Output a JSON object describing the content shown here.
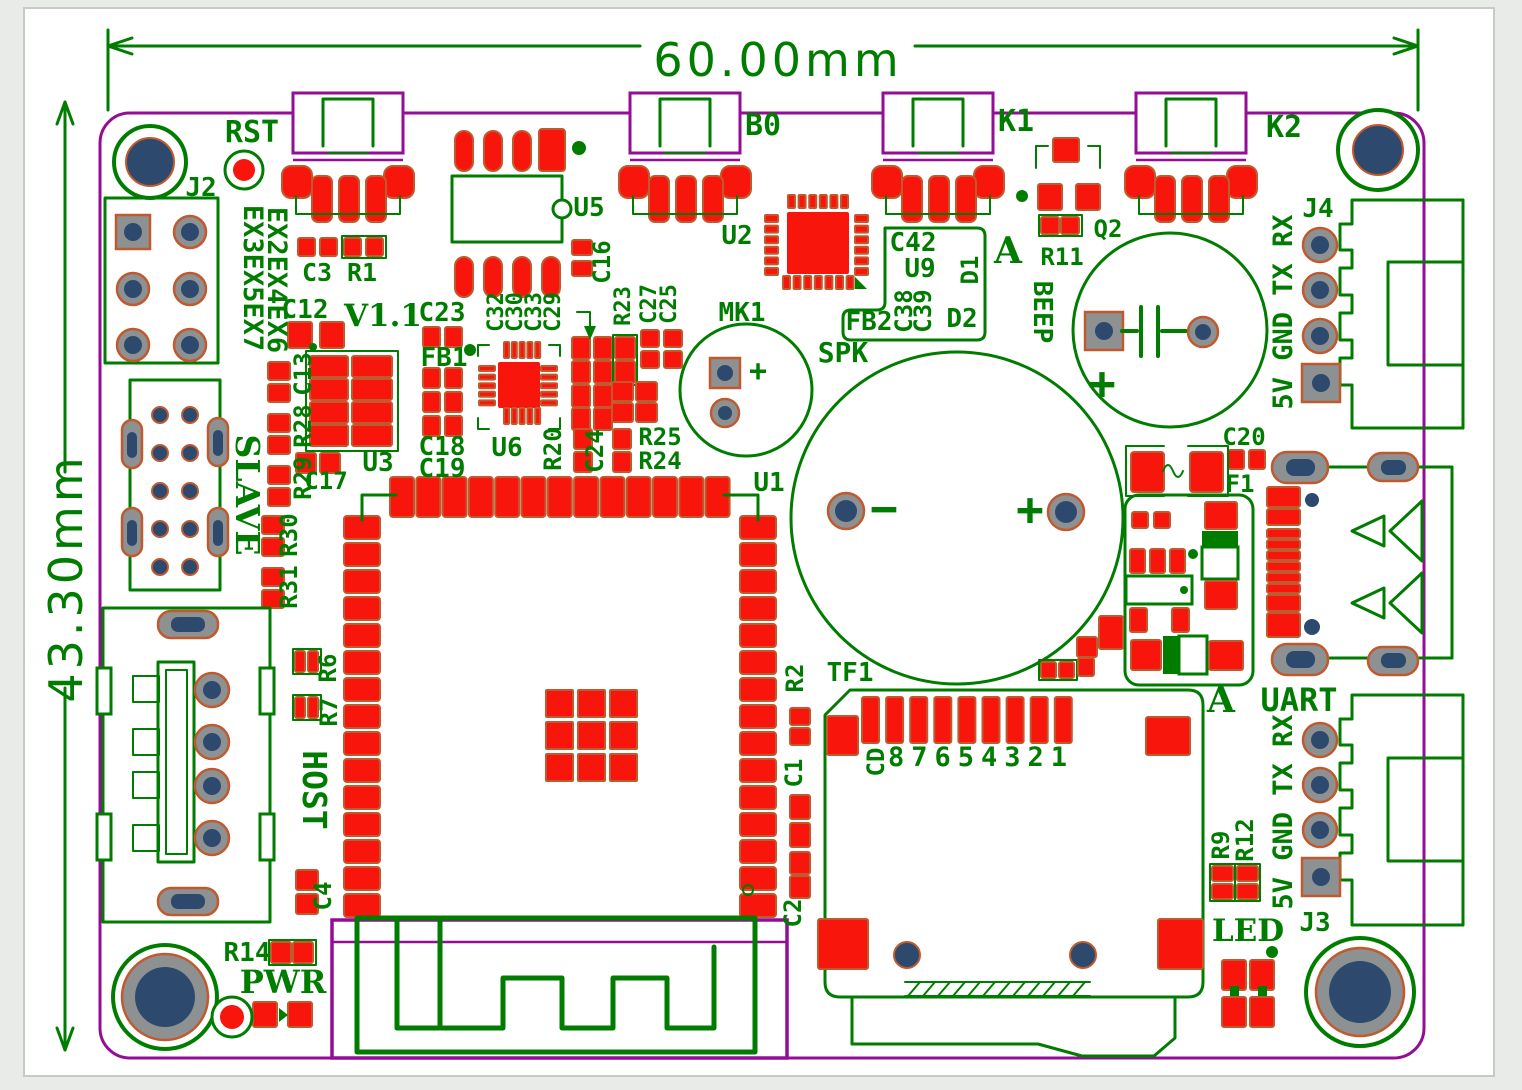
{
  "meta": {
    "type": "pcb-layout-drawing",
    "board_version": "V1.1"
  },
  "dimensions": {
    "width": "60.00mm",
    "height": "43.30mm"
  },
  "colors": {
    "silkscreen": "#007d00",
    "copper_pad": "#f8150b",
    "pad_outline": "#c05a2e",
    "board_edge": "#930d96",
    "drill_hole": "#2d4a6e",
    "pad_ring_gray": "#8e9192",
    "background": "#e9ebe8",
    "canvas": "#ffffff"
  },
  "labels": [
    {
      "t": "60.00mm",
      "x": 778,
      "y": 76,
      "s": 46,
      "c": "dim",
      "ls": 4
    },
    {
      "t": "43.30mm",
      "x": 82,
      "y": 578,
      "r": -90,
      "s": 46,
      "c": "dim",
      "ls": 4
    },
    {
      "t": "RST",
      "x": 252,
      "y": 142,
      "s": 30
    },
    {
      "t": "J2",
      "x": 201,
      "y": 196,
      "s": 26
    },
    {
      "t": "EX3EX5EX7",
      "x": 244,
      "y": 278,
      "r": 90,
      "s": 27
    },
    {
      "t": "EX2EX4EX6",
      "x": 268,
      "y": 280,
      "r": 90,
      "s": 27
    },
    {
      "t": "C3",
      "x": 317,
      "y": 281,
      "s": 25
    },
    {
      "t": "R1",
      "x": 362,
      "y": 281,
      "s": 25
    },
    {
      "t": "C12",
      "x": 305,
      "y": 318,
      "s": 26
    },
    {
      "t": "V1.1",
      "x": 383,
      "y": 326,
      "s": 31,
      "c": "b"
    },
    {
      "t": "C23",
      "x": 442,
      "y": 321,
      "s": 26
    },
    {
      "t": "FB1",
      "x": 444,
      "y": 366,
      "s": 26
    },
    {
      "t": "C18",
      "x": 442,
      "y": 455,
      "s": 26
    },
    {
      "t": "C19",
      "x": 442,
      "y": 477,
      "s": 26
    },
    {
      "t": "U3",
      "x": 378,
      "y": 471,
      "s": 26
    },
    {
      "t": "C13",
      "x": 311,
      "y": 374,
      "r": -90,
      "s": 24
    },
    {
      "t": "R28",
      "x": 311,
      "y": 426,
      "r": -90,
      "s": 24
    },
    {
      "t": "R29",
      "x": 311,
      "y": 478,
      "r": -90,
      "s": 24
    },
    {
      "t": "C17",
      "x": 326,
      "y": 489,
      "s": 24
    },
    {
      "t": "R30",
      "x": 297,
      "y": 535,
      "r": -90,
      "s": 24
    },
    {
      "t": "R31",
      "x": 297,
      "y": 587,
      "r": -90,
      "s": 24
    },
    {
      "t": "SLAVE",
      "x": 236,
      "y": 495,
      "r": 90,
      "s": 33,
      "c": "b"
    },
    {
      "t": "HOST",
      "x": 303,
      "y": 790,
      "r": 90,
      "s": 33
    },
    {
      "t": "R6",
      "x": 336,
      "y": 668,
      "r": -90,
      "s": 24
    },
    {
      "t": "R7",
      "x": 337,
      "y": 712,
      "r": -90,
      "s": 24
    },
    {
      "t": "C4",
      "x": 331,
      "y": 896,
      "r": -90,
      "s": 24
    },
    {
      "t": "R14",
      "x": 247,
      "y": 961,
      "s": 26
    },
    {
      "t": "PWR",
      "x": 283,
      "y": 993,
      "s": 32,
      "c": "b"
    },
    {
      "t": "U5",
      "x": 589,
      "y": 216,
      "s": 26
    },
    {
      "t": "C16",
      "x": 610,
      "y": 262,
      "r": -90,
      "s": 24
    },
    {
      "t": "C32",
      "x": 503,
      "y": 312,
      "r": -90,
      "s": 22
    },
    {
      "t": "C30",
      "x": 522,
      "y": 312,
      "r": -90,
      "s": 22
    },
    {
      "t": "C33",
      "x": 541,
      "y": 312,
      "r": -90,
      "s": 22
    },
    {
      "t": "C29",
      "x": 560,
      "y": 312,
      "r": -90,
      "s": 22
    },
    {
      "t": "R23",
      "x": 630,
      "y": 306,
      "r": -90,
      "s": 22
    },
    {
      "t": "C27",
      "x": 656,
      "y": 304,
      "r": -90,
      "s": 22
    },
    {
      "t": "C25",
      "x": 676,
      "y": 304,
      "r": -90,
      "s": 22
    },
    {
      "t": "U6",
      "x": 507,
      "y": 456,
      "s": 26
    },
    {
      "t": "R20",
      "x": 561,
      "y": 449,
      "r": -90,
      "s": 24
    },
    {
      "t": "C24",
      "x": 603,
      "y": 451,
      "r": -90,
      "s": 24
    },
    {
      "t": "R25",
      "x": 660,
      "y": 445,
      "s": 24
    },
    {
      "t": "R24",
      "x": 660,
      "y": 469,
      "s": 24
    },
    {
      "t": "U1",
      "x": 769,
      "y": 491,
      "s": 26
    },
    {
      "t": "B0",
      "x": 763,
      "y": 135,
      "s": 30
    },
    {
      "t": "U2",
      "x": 737,
      "y": 244,
      "s": 26
    },
    {
      "t": "MK1",
      "x": 742,
      "y": 321,
      "s": 26
    },
    {
      "t": "SPK",
      "x": 843,
      "y": 362,
      "s": 28
    },
    {
      "t": "−",
      "x": 884,
      "y": 524,
      "s": 46
    },
    {
      "t": "+",
      "x": 1030,
      "y": 525,
      "s": 46
    },
    {
      "t": "+",
      "x": 758,
      "y": 381,
      "s": 30
    },
    {
      "t": "C42",
      "x": 913,
      "y": 251,
      "s": 26
    },
    {
      "t": "U9",
      "x": 920,
      "y": 277,
      "s": 26
    },
    {
      "t": "D1",
      "x": 978,
      "y": 270,
      "r": -90,
      "s": 24
    },
    {
      "t": "FB2",
      "x": 869,
      "y": 330,
      "s": 26
    },
    {
      "t": "C38",
      "x": 912,
      "y": 311,
      "r": -90,
      "s": 24
    },
    {
      "t": "C39",
      "x": 931,
      "y": 311,
      "r": -90,
      "s": 24
    },
    {
      "t": "D2",
      "x": 962,
      "y": 327,
      "s": 26
    },
    {
      "t": "A",
      "x": 1008,
      "y": 263,
      "s": 36,
      "c": "b"
    },
    {
      "t": "K1",
      "x": 1016,
      "y": 131,
      "s": 30
    },
    {
      "t": "Q2",
      "x": 1108,
      "y": 237,
      "s": 24
    },
    {
      "t": "R11",
      "x": 1062,
      "y": 265,
      "s": 24
    },
    {
      "t": "BEEP",
      "x": 1034,
      "y": 312,
      "r": 90,
      "s": 26
    },
    {
      "t": "+",
      "x": 1102,
      "y": 399,
      "s": 46
    },
    {
      "t": "K2",
      "x": 1284,
      "y": 137,
      "s": 30
    },
    {
      "t": "J4",
      "x": 1318,
      "y": 217,
      "s": 26
    },
    {
      "t": "5V GND TX RX",
      "x": 1292,
      "y": 312,
      "r": -90,
      "s": 27
    },
    {
      "t": "C20",
      "x": 1244,
      "y": 445,
      "s": 24
    },
    {
      "t": "F1",
      "x": 1240,
      "y": 492,
      "s": 24
    },
    {
      "t": "A",
      "x": 1221,
      "y": 712,
      "s": 36,
      "c": "b"
    },
    {
      "t": "UART",
      "x": 1299,
      "y": 711,
      "s": 32
    },
    {
      "t": "TF1",
      "x": 850,
      "y": 681,
      "s": 26
    },
    {
      "t": "CD",
      "x": 884,
      "y": 762,
      "r": -90,
      "s": 24
    },
    {
      "t": "87654321",
      "x": 981,
      "y": 766,
      "s": 27,
      "ls": 7
    },
    {
      "t": "R2",
      "x": 803,
      "y": 678,
      "r": -90,
      "s": 24
    },
    {
      "t": "C1",
      "x": 802,
      "y": 773,
      "r": -90,
      "s": 24
    },
    {
      "t": "C2",
      "x": 801,
      "y": 913,
      "r": -90,
      "s": 24
    },
    {
      "t": "R9",
      "x": 1229,
      "y": 845,
      "r": -90,
      "s": 24
    },
    {
      "t": "R12",
      "x": 1253,
      "y": 840,
      "r": -90,
      "s": 24
    },
    {
      "t": "LED",
      "x": 1248,
      "y": 941,
      "s": 31,
      "c": "b"
    },
    {
      "t": "J3",
      "x": 1315,
      "y": 931,
      "s": 26
    },
    {
      "t": "5V GND TX RX",
      "x": 1292,
      "y": 812,
      "r": -90,
      "s": 27
    }
  ]
}
